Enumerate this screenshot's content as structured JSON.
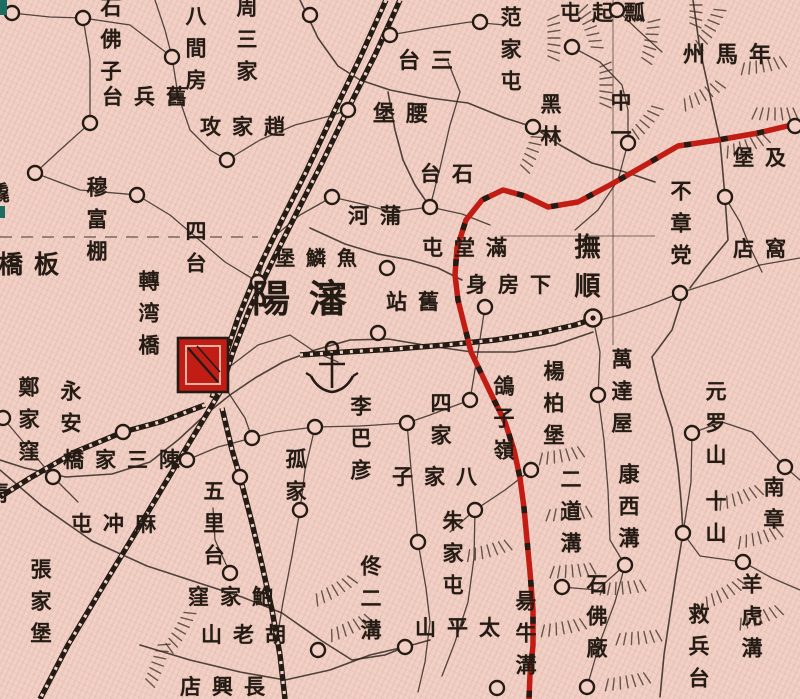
{
  "map": {
    "colors": {
      "paper": "#f2d0c5",
      "ink": "#241c14",
      "boundary_red": "#c21d15",
      "city_red": "#c21d15",
      "edge_teal": "#1d6d62"
    },
    "symbols": {
      "walled_city": "red-hatched-square",
      "county_seat": "double-circle-with-dot",
      "town": "small-circle",
      "anchor": "anchor-mark",
      "railway": "black-line-with-crossties",
      "boundary": "red-line-with-black-dashes"
    },
    "labels": [
      {
        "name": "石佛子",
        "disp": "石佛子",
        "o": "v",
        "x": 100,
        "y": -4,
        "s": 21
      },
      {
        "name": "八間房",
        "disp": "八間房",
        "o": "v",
        "x": 185,
        "y": 5,
        "s": 21
      },
      {
        "name": "周三家",
        "disp": "周三家",
        "o": "v",
        "x": 236,
        "y": -4,
        "s": 21
      },
      {
        "name": "舊兵台",
        "disp": "台兵舊",
        "o": "h",
        "x": 102,
        "y": 86,
        "s": 21
      },
      {
        "name": "趙家攻",
        "disp": "攻家趙",
        "o": "h",
        "x": 200,
        "y": 116,
        "s": 21
      },
      {
        "name": "穆富棚",
        "disp": "穆富棚",
        "o": "v",
        "x": 86,
        "y": 176,
        "s": 21
      },
      {
        "name": "板橋",
        "disp": "橋板",
        "o": "h",
        "x": -2,
        "y": 252,
        "s": 25
      },
      {
        "name": "四台",
        "disp": "四台",
        "o": "v",
        "x": 185,
        "y": 220,
        "s": 21
      },
      {
        "name": "轉湾橋",
        "disp": "轉湾橋",
        "o": "v",
        "x": 138,
        "y": 270,
        "s": 21
      },
      {
        "name": "瀋陽",
        "disp": "陽瀋",
        "o": "h",
        "x": 252,
        "y": 280,
        "s": 38
      },
      {
        "name": "魚鱗堡",
        "disp": "堡鱗魚",
        "o": "h",
        "x": 275,
        "y": 248,
        "s": 20
      },
      {
        "name": "蒲河",
        "disp": "河蒲",
        "o": "h",
        "x": 348,
        "y": 205,
        "s": 21
      },
      {
        "name": "三台",
        "disp": "台三",
        "o": "h",
        "x": 398,
        "y": 50,
        "s": 22
      },
      {
        "name": "腰堡",
        "disp": "堡腰",
        "o": "h",
        "x": 373,
        "y": 103,
        "s": 22
      },
      {
        "name": "石台",
        "disp": "台石",
        "o": "h",
        "x": 420,
        "y": 163,
        "s": 21
      },
      {
        "name": "范家屯",
        "disp": "范家屯",
        "o": "v",
        "x": 500,
        "y": 6,
        "s": 21
      },
      {
        "name": "瓢起屯",
        "disp": "屯起瓢",
        "o": "h",
        "x": 560,
        "y": 2,
        "s": 21
      },
      {
        "name": "年馬州",
        "disp": "州馬年",
        "o": "h",
        "x": 683,
        "y": 44,
        "s": 22
      },
      {
        "name": "黑林",
        "disp": "黑林",
        "o": "v",
        "x": 540,
        "y": 93,
        "s": 21
      },
      {
        "name": "中一",
        "disp": "中一",
        "o": "v",
        "x": 610,
        "y": 90,
        "s": 21
      },
      {
        "name": "及堡",
        "disp": "堡及",
        "o": "h",
        "x": 733,
        "y": 147,
        "s": 21
      },
      {
        "name": "不章党",
        "disp": "不章党",
        "o": "v",
        "x": 670,
        "y": 180,
        "s": 21
      },
      {
        "name": "窩店",
        "disp": "店窩",
        "o": "h",
        "x": 733,
        "y": 238,
        "s": 21
      },
      {
        "name": "撫順",
        "disp": "撫順",
        "o": "v",
        "x": 572,
        "y": 233,
        "s": 26
      },
      {
        "name": "滿堂屯",
        "disp": "屯堂滿",
        "o": "h",
        "x": 422,
        "y": 237,
        "s": 21
      },
      {
        "name": "下房身",
        "disp": "身房下",
        "o": "h",
        "x": 466,
        "y": 274,
        "s": 21
      },
      {
        "name": "舊站",
        "disp": "站舊",
        "o": "h",
        "x": 386,
        "y": 291,
        "s": 21
      },
      {
        "name": "萬達屋",
        "disp": "萬達屋",
        "o": "v",
        "x": 611,
        "y": 348,
        "s": 21
      },
      {
        "name": "康西溝",
        "disp": "康西溝",
        "o": "v",
        "x": 618,
        "y": 463,
        "s": 21
      },
      {
        "name": "楊柏堡",
        "disp": "楊柏堡",
        "o": "v",
        "x": 543,
        "y": 360,
        "s": 21
      },
      {
        "name": "二道溝",
        "disp": "二道溝",
        "o": "v",
        "x": 560,
        "y": 468,
        "s": 21
      },
      {
        "name": "元罗山",
        "disp": "元罗山",
        "o": "v",
        "x": 705,
        "y": 380,
        "s": 21
      },
      {
        "name": "十山",
        "disp": "十山",
        "o": "v",
        "x": 705,
        "y": 490,
        "s": 21
      },
      {
        "name": "南章",
        "disp": "南章",
        "o": "v",
        "x": 763,
        "y": 476,
        "s": 21
      },
      {
        "name": "鴿子嶺",
        "disp": "鴿子嶺",
        "o": "v",
        "x": 493,
        "y": 375,
        "s": 21
      },
      {
        "name": "四家",
        "disp": "四家",
        "o": "v",
        "x": 430,
        "y": 392,
        "s": 21
      },
      {
        "name": "八家子",
        "disp": "子家八",
        "o": "h",
        "x": 392,
        "y": 466,
        "s": 21
      },
      {
        "name": "朱家屯",
        "disp": "朱家屯",
        "o": "v",
        "x": 442,
        "y": 510,
        "s": 21
      },
      {
        "name": "李巴彦",
        "disp": "李巴彦",
        "o": "v",
        "x": 350,
        "y": 395,
        "s": 21
      },
      {
        "name": "佟二溝",
        "disp": "佟二溝",
        "o": "v",
        "x": 360,
        "y": 555,
        "s": 21
      },
      {
        "name": "太平山",
        "disp": "山平太",
        "o": "h",
        "x": 415,
        "y": 617,
        "s": 21
      },
      {
        "name": "昜牛溝",
        "disp": "昜牛溝",
        "o": "v",
        "x": 515,
        "y": 590,
        "s": 21
      },
      {
        "name": "石佛廠",
        "disp": "石佛廠",
        "o": "v",
        "x": 586,
        "y": 573,
        "s": 21
      },
      {
        "name": "救兵台",
        "disp": "救兵台",
        "o": "v",
        "x": 688,
        "y": 603,
        "s": 21
      },
      {
        "name": "羊虎溝",
        "disp": "羊虎溝",
        "o": "v",
        "x": 741,
        "y": 573,
        "s": 21
      },
      {
        "name": "永安",
        "disp": "永安",
        "o": "v",
        "x": 60,
        "y": 380,
        "s": 21
      },
      {
        "name": "陳三家橋",
        "disp": "橋家三陳",
        "o": "h",
        "x": 63,
        "y": 449,
        "s": 21
      },
      {
        "name": "鄭家窪",
        "disp": "鄭家窪",
        "o": "v",
        "x": 18,
        "y": 376,
        "s": 21
      },
      {
        "name": "麻冲屯",
        "disp": "屯冲麻",
        "o": "h",
        "x": 71,
        "y": 513,
        "s": 21
      },
      {
        "name": "張家堡",
        "disp": "張家堡",
        "o": "v",
        "x": 30,
        "y": 558,
        "s": 21
      },
      {
        "name": "五里台",
        "disp": "五里台",
        "o": "v",
        "x": 203,
        "y": 480,
        "s": 21
      },
      {
        "name": "孤家",
        "disp": "孤家",
        "o": "v",
        "x": 285,
        "y": 448,
        "s": 21
      },
      {
        "name": "鮑家窪",
        "disp": "窪家鮑",
        "o": "h",
        "x": 188,
        "y": 586,
        "s": 21
      },
      {
        "name": "胡老山",
        "disp": "山老胡",
        "o": "h",
        "x": 201,
        "y": 624,
        "s": 21
      },
      {
        "name": "長興店",
        "disp": "店興長",
        "o": "h",
        "x": 180,
        "y": 676,
        "s": 21
      },
      {
        "name": "橇",
        "disp": "橇",
        "o": "v",
        "x": -12,
        "y": 182,
        "s": 21
      },
      {
        "name": "靑",
        "disp": "靑",
        "o": "v",
        "x": -12,
        "y": 482,
        "s": 21
      }
    ],
    "markers": [
      {
        "x": 12,
        "y": 13,
        "t": "town"
      },
      {
        "x": 83,
        "y": 18,
        "t": "town"
      },
      {
        "x": 172,
        "y": 57,
        "t": "town"
      },
      {
        "x": 90,
        "y": 123,
        "t": "town"
      },
      {
        "x": 227,
        "y": 160,
        "t": "town"
      },
      {
        "x": 35,
        "y": 173,
        "t": "town"
      },
      {
        "x": 137,
        "y": 195,
        "t": "town"
      },
      {
        "x": 310,
        "y": 15,
        "t": "town"
      },
      {
        "x": 390,
        "y": 35,
        "t": "town"
      },
      {
        "x": 348,
        "y": 110,
        "t": "town"
      },
      {
        "x": 332,
        "y": 197,
        "t": "town"
      },
      {
        "x": 480,
        "y": 22,
        "t": "town"
      },
      {
        "x": 533,
        "y": 127,
        "t": "town"
      },
      {
        "x": 572,
        "y": 47,
        "t": "town"
      },
      {
        "x": 617,
        "y": 10,
        "t": "town"
      },
      {
        "x": 628,
        "y": 143,
        "t": "town"
      },
      {
        "x": 725,
        "y": 197,
        "t": "town"
      },
      {
        "x": 430,
        "y": 207,
        "t": "town"
      },
      {
        "x": 387,
        "y": 268,
        "t": "town"
      },
      {
        "x": 258,
        "y": 282,
        "t": "town"
      },
      {
        "x": 378,
        "y": 333,
        "t": "town"
      },
      {
        "x": 485,
        "y": 307,
        "t": "town"
      },
      {
        "x": 680,
        "y": 293,
        "t": "town"
      },
      {
        "x": 598,
        "y": 395,
        "t": "town"
      },
      {
        "x": 692,
        "y": 433,
        "t": "town"
      },
      {
        "x": 683,
        "y": 533,
        "t": "town"
      },
      {
        "x": 785,
        "y": 467,
        "t": "town"
      },
      {
        "x": 531,
        "y": 470,
        "t": "town"
      },
      {
        "x": 470,
        "y": 400,
        "t": "town"
      },
      {
        "x": 407,
        "y": 423,
        "t": "town"
      },
      {
        "x": 315,
        "y": 427,
        "t": "town"
      },
      {
        "x": 475,
        "y": 510,
        "t": "town"
      },
      {
        "x": 418,
        "y": 542,
        "t": "town"
      },
      {
        "x": 562,
        "y": 587,
        "t": "town"
      },
      {
        "x": 625,
        "y": 565,
        "t": "town"
      },
      {
        "x": 587,
        "y": 687,
        "t": "town"
      },
      {
        "x": 743,
        "y": 562,
        "t": "town"
      },
      {
        "x": 405,
        "y": 647,
        "t": "town"
      },
      {
        "x": 318,
        "y": 650,
        "t": "town"
      },
      {
        "x": 300,
        "y": 510,
        "t": "town"
      },
      {
        "x": 240,
        "y": 477,
        "t": "town"
      },
      {
        "x": 187,
        "y": 460,
        "t": "town"
      },
      {
        "x": 252,
        "y": 438,
        "t": "town"
      },
      {
        "x": 123,
        "y": 432,
        "t": "town"
      },
      {
        "x": 53,
        "y": 477,
        "t": "town"
      },
      {
        "x": 230,
        "y": 573,
        "t": "town"
      },
      {
        "x": 3,
        "y": 418,
        "t": "town"
      },
      {
        "x": 497,
        "y": 688,
        "t": "town"
      },
      {
        "x": 795,
        "y": 126,
        "t": "town"
      },
      {
        "x": 593,
        "y": 318,
        "t": "seat"
      }
    ]
  }
}
